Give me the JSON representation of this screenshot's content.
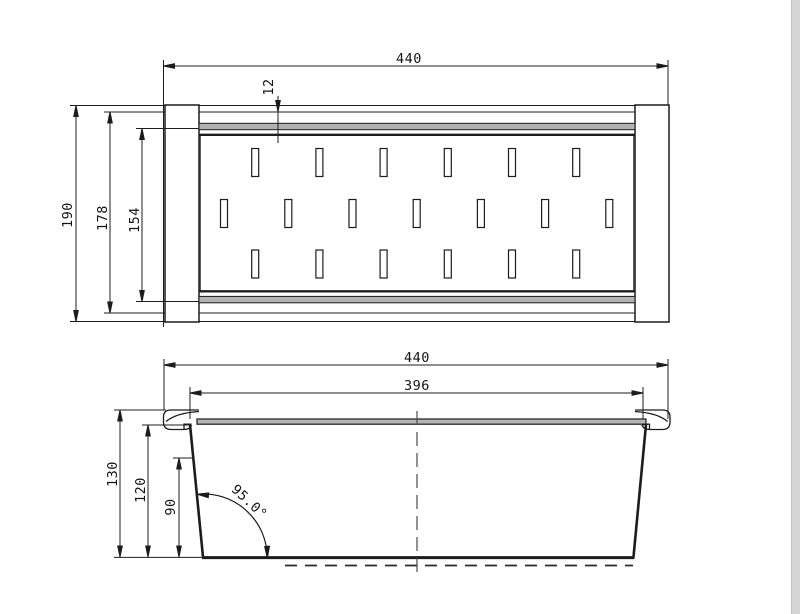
{
  "meta": {
    "type": "technical-drawing",
    "subject": "Dimensioned 2-view CAD drawing of an over-sink strainer / colander basket with slotted base",
    "units": "mm",
    "colors": {
      "line": "#1c1c1c",
      "rail_fill": "#b2b2b2",
      "rim_fill": "#b5b5b5",
      "background": "#ffffff",
      "edge_strip": "#d5d5d5"
    }
  },
  "top_view": {
    "name": "plan-view",
    "dimensions": {
      "overall_width": "440",
      "rail_offset": "12",
      "overall_depth": "190",
      "body_depth": "178",
      "inner_depth": "154"
    },
    "slots": {
      "rows": 3,
      "per_row": [
        6,
        7,
        6
      ],
      "total": 19
    }
  },
  "side_view": {
    "name": "front-elevation-view",
    "dimensions": {
      "overall_width": "440",
      "inner_width": "396",
      "overall_height": "130",
      "body_height": "120",
      "inner_height": "90",
      "wall_angle": "95.0°"
    }
  }
}
